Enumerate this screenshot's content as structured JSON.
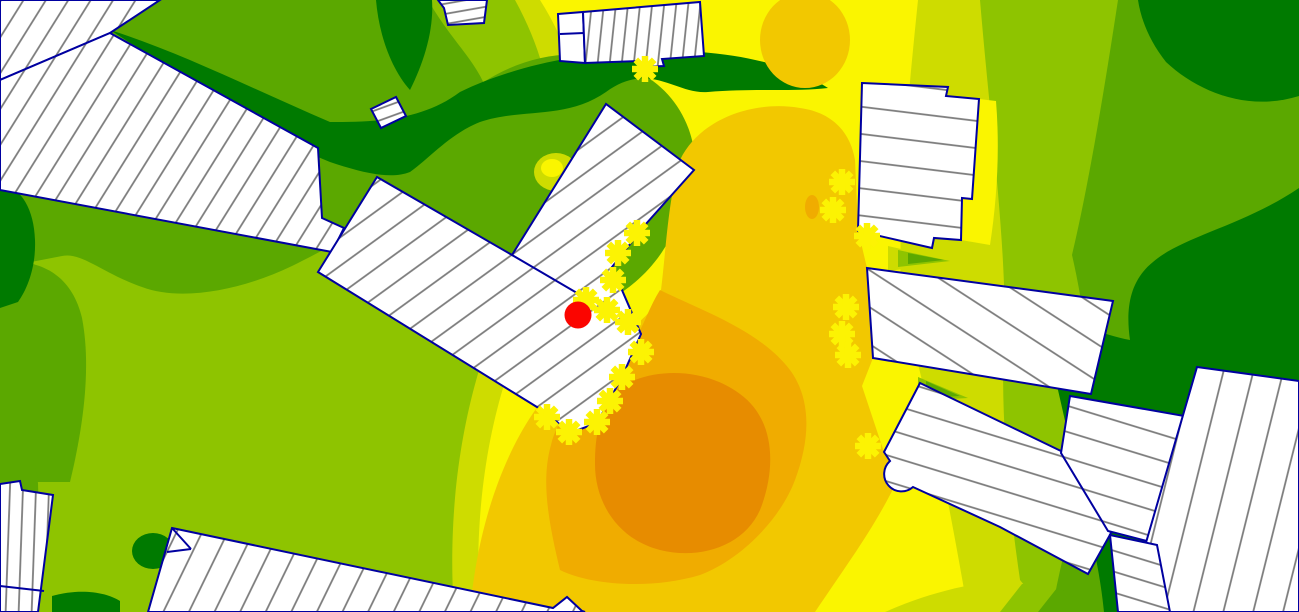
{
  "map": {
    "width": 1299,
    "height": 612,
    "description": "noise-contour-map-view",
    "palette": {
      "band_lt45": "#007A00",
      "band_45_50": "#5BA800",
      "band_50_55": "#8EC400",
      "band_55_60": "#CEDC00",
      "band_60_65": "#FAF500",
      "band_65_70": "#F2C800",
      "band_70_75": "#F0AC00",
      "band_gt75": "#E78C00",
      "building_fill": "#FFFFFF",
      "building_outline": "#0000A0",
      "hatch_line": "#7A7A7A",
      "receiver_marker": "#FCF303",
      "source_marker": "#FB0500"
    },
    "contours": [
      {
        "name": "base-yellow",
        "color": "band_60_65",
        "type": "path",
        "d": "M0,0 H1299 V612 H0 Z"
      },
      {
        "name": "left-yellowgreen",
        "color": "band_55_60",
        "type": "path",
        "d": "M0,0 L540,0 C575,55 585,110 582,165 C578,235 548,275 530,315 C505,372 488,430 481,505 C477,550 478,585 480,612 L0,612 Z"
      },
      {
        "name": "left-lightgreen",
        "color": "band_50_55",
        "type": "path",
        "d": "M0,0 L515,0 C548,60 556,115 552,165 C548,230 520,262 504,300 C480,358 462,420 455,498 C451,545 452,582 454,612 L0,612 Z"
      },
      {
        "name": "topleft-green",
        "color": "band_45_50",
        "type": "path",
        "d": "M0,0 L428,0 C452,42 478,62 488,94 C494,132 462,162 430,186 C392,214 332,246 292,266 C242,290 182,302 142,287 C102,273 82,252 62,256 L0,268 Z"
      },
      {
        "name": "leftedge-green",
        "color": "band_45_50",
        "type": "path",
        "d": "M0,262 C42,258 72,276 82,318 C92,370 82,432 70,482 L0,482 Z"
      },
      {
        "name": "leftlow-green",
        "color": "band_45_50",
        "type": "path",
        "d": "M0,430 C26,436 40,462 38,496 C36,530 20,552 0,556 Z"
      },
      {
        "name": "center-green-blob",
        "color": "band_45_50",
        "type": "path",
        "d": "M352,196 C402,160 432,120 472,90 C512,60 562,48 602,58 C652,70 682,100 692,140 C702,180 682,222 662,252 C642,282 612,302 582,312 C542,324 482,330 442,320 C402,310 372,282 357,252 C347,230 347,214 352,196 Z"
      },
      {
        "name": "darkgreen-band",
        "color": "band_lt45",
        "type": "path",
        "d": "M110,30 C180,52 255,90 330,122 C370,122 420,122 460,92 C530,58 620,46 700,52 C755,56 800,70 828,88 C795,92 755,88 708,92 C676,95 650,60 606,92 C566,120 520,108 480,122 C450,134 432,156 410,172 C390,180 360,172 330,162 C260,134 180,74 110,30 Z"
      },
      {
        "name": "darkgreen-spur",
        "color": "band_lt45",
        "type": "path",
        "d": "M376,0 L432,0 C434,30 424,62 410,90 C392,70 379,36 376,0 Z"
      },
      {
        "name": "darkgreen-leftedge",
        "color": "band_lt45",
        "type": "path",
        "d": "M0,182 C22,188 34,210 35,240 C36,266 28,288 18,302 L0,308 Z"
      },
      {
        "name": "darkgreen-tip",
        "color": "band_lt45",
        "type": "ellipse",
        "cx": 153,
        "cy": 551,
        "rx": 21,
        "ry": 18
      },
      {
        "name": "darkgreen-bottomleft",
        "color": "band_lt45",
        "type": "path",
        "d": "M52,596 C80,588 106,592 120,601 L120,612 L52,612 Z"
      },
      {
        "name": "right-yellowgreen",
        "color": "band_55_60",
        "type": "path",
        "d": "M918,0 L1299,0 L1299,612 L968,612 C952,520 930,400 901,300 C898,198 908,98 918,0 Z"
      },
      {
        "name": "right-lightgreen",
        "color": "band_50_55",
        "type": "path",
        "d": "M980,0 L1299,0 L1299,612 L1025,612 C1010,520 1000,420 1004,340 C1008,258 990,120 980,0 Z"
      },
      {
        "name": "right-green",
        "color": "band_45_50",
        "type": "path",
        "d": "M1118,0 L1299,0 L1299,612 L1052,612 C1062,548 1082,498 1088,438 C1095,375 1082,298 1072,255 C1088,188 1104,92 1118,0 Z"
      },
      {
        "name": "darkgreen-topright",
        "color": "band_lt45",
        "type": "path",
        "d": "M1138,0 L1299,0 L1299,96 C1248,112 1198,92 1166,62 C1150,42 1141,20 1138,0 Z"
      },
      {
        "name": "darkgreen-right-mass",
        "color": "band_lt45",
        "type": "path",
        "d": "M1299,188 C1243,226 1183,236 1153,262 C1128,282 1126,312 1130,340 C1103,335 1073,322 1043,312 L966,296 C1000,318 1040,352 1058,390 L1078,478 C1090,530 1100,570 1104,612 L1299,612 Z"
      },
      {
        "name": "yellow-halo-b6",
        "color": "band_60_65",
        "type": "path",
        "d": "M979,99 L996,101 C1000,150 997,200 990,245 L961,240 L961,198 L972,199 Z"
      },
      {
        "name": "gold-top-patch",
        "color": "band_65_70",
        "type": "ellipse",
        "cx": 805,
        "cy": 40,
        "rx": 45,
        "ry": 48
      },
      {
        "name": "gold-main",
        "color": "band_65_70",
        "type": "path",
        "d": "M680,160 C700,118 755,100 800,108 C830,112 850,130 855,160 L858,230 L867,268 L873,358 L862,386 L884,452 L902,470 C880,520 850,560 815,612 L470,612 C480,498 520,420 560,380 C600,340 650,330 661,290 C666,250 668,200 680,160 Z"
      },
      {
        "name": "orange-blob",
        "color": "band_70_75",
        "type": "path",
        "d": "M660,290 C700,310 760,330 790,370 C812,400 810,440 795,480 C780,520 740,560 700,575 C650,590 590,585 560,570 C548,520 541,480 551,445 C559,408 596,388 621,358 C641,338 646,312 660,290 Z"
      },
      {
        "name": "deep-orange-core",
        "color": "band_gt75",
        "type": "path",
        "d": "M612,394 C640,368 700,364 740,394 C776,420 776,470 760,510 C744,546 700,560 660,550 C620,540 595,505 595,464 C595,434 600,414 612,394 Z"
      },
      {
        "name": "orange-spot",
        "color": "band_70_75",
        "type": "ellipse",
        "cx": 812,
        "cy": 207,
        "rx": 7,
        "ry": 12
      },
      {
        "name": "yg-spot",
        "color": "band_55_60",
        "type": "ellipse",
        "cx": 556,
        "cy": 172,
        "rx": 22,
        "ry": 19
      },
      {
        "name": "yellow-spot",
        "color": "band_60_65",
        "type": "ellipse",
        "cx": 552,
        "cy": 168,
        "rx": 11,
        "ry": 9
      },
      {
        "name": "wedge-yg-bottom",
        "color": "band_55_60",
        "type": "path",
        "d": "M885,612 C930,592 980,580 1020,580 L1046,612 Z"
      },
      {
        "name": "wedge-lg-bottom",
        "color": "band_50_55",
        "type": "path",
        "d": "M1000,612 L1022,584 C1040,582 1052,590 1058,600 L1062,612 Z"
      },
      {
        "name": "wedge-g-bottom",
        "color": "band_45_50",
        "type": "path",
        "d": "M1038,612 L1057,588 C1070,592 1081,602 1086,612 Z"
      },
      {
        "name": "wedge-lg-a",
        "color": "band_50_55",
        "type": "path",
        "d": "M918,377 L968,398 L918,401 Z"
      },
      {
        "name": "wedge-g-a",
        "color": "band_45_50",
        "type": "path",
        "d": "M926,381 L960,396 L926,398 Z"
      },
      {
        "name": "wedge-yg-shadow",
        "color": "band_55_60",
        "type": "path",
        "d": "M888,246 L958,262 L888,271 Z"
      },
      {
        "name": "wedge-lg-shadow",
        "color": "band_50_55",
        "type": "path",
        "d": "M898,250 L950,261 L898,267 Z"
      },
      {
        "name": "wedge-g-shadow",
        "color": "band_45_50",
        "type": "path",
        "d": "M908,253 L944,260 L908,264 Z"
      }
    ],
    "buildings": [
      {
        "name": "building-topleft-strip",
        "d": "M0,0 L160,0 L110,33 L0,80 Z",
        "hatch_angle": -58,
        "hatch_gap": 19
      },
      {
        "name": "building-long-diagonal",
        "d": "M110,33 L318,148 L322,218 L344,228 L332,252 L0,190 L0,80 Z",
        "hatch_angle": -58,
        "hatch_gap": 19
      },
      {
        "name": "building-small-tilted",
        "d": "M371,109 L396,97 L406,116 L381,128 Z",
        "hatch_angle": -20,
        "hatch_gap": 11
      },
      {
        "name": "building-topedge-small",
        "d": "M438,0 L487,0 L484,23 L448,25 L444,8 Z",
        "hatch_angle": -10,
        "hatch_gap": 10
      },
      {
        "name": "building-top-annex",
        "d": "M558,14 L583,12 L585,63 L560,61 Z",
        "hatch_angle": -84,
        "hatch_gap": 60
      },
      {
        "name": "building-top-main",
        "d": "M583,12 L700,2 L704,56 L662,59 L664,66 L640,67 L638,61 L585,63 Z",
        "hatch_angle": -84,
        "hatch_gap": 12
      },
      {
        "name": "building-upper-right",
        "d": "M862,83 L948,87 L946,96 L979,99 L972,199 L962,198 L961,240 L934,238 L932,248 L858,231 Z",
        "hatch_angle": 7,
        "hatch_gap": 27
      },
      {
        "name": "building-right-wide",
        "d": "M867,268 L1113,301 L1091,394 L873,358 Z",
        "hatch_angle": 33,
        "hatch_gap": 31
      },
      {
        "name": "building-central-complex",
        "d": "M377,177 L512,255 L606,104 L694,170 L645,225 L612,267 L641,334 L622,377 L597,423 L570,433 L545,412 L318,272 Z",
        "hatch_angle": -36,
        "hatch_gap": 23
      },
      {
        "name": "building-cluster-a",
        "d": "M920,383 L1063,452 L1111,533 L1088,574 L1000,527 L913,487 A13,13 0 0,1 890,461 L884,452 Z",
        "hatch_angle": 17,
        "hatch_gap": 25
      },
      {
        "name": "building-cluster-b",
        "d": "M1070,396 L1190,417 L1168,492 L1147,541 L1108,531 L1061,453 Z",
        "hatch_angle": 17,
        "hatch_gap": 25
      },
      {
        "name": "building-cluster-c",
        "d": "M1197,367 L1299,381 L1299,612 L1160,612 L1136,577 Z",
        "hatch_angle": -76,
        "hatch_gap": 29
      },
      {
        "name": "building-cluster-d",
        "d": "M1110,535 L1157,545 L1170,612 L1118,612 Z",
        "hatch_angle": 17,
        "hatch_gap": 20
      },
      {
        "name": "building-left-edge",
        "d": "M0,484 L20,481 L22,490 L53,495 L38,612 L0,612 Z",
        "hatch_angle": -88,
        "hatch_gap": 13
      },
      {
        "name": "building-bottom-triangle",
        "d": "M172,528 L553,608 L567,597 L582,611 L585,612 L148,612 Z",
        "hatch_angle": -64,
        "hatch_gap": 23
      }
    ],
    "building_lines": [
      {
        "name": "complex-inner-edge",
        "x1": 512,
        "y1": 255,
        "x2": 577,
        "y2": 293
      },
      {
        "name": "annex-divider",
        "x1": 560,
        "y1": 34,
        "x2": 584,
        "y2": 33
      },
      {
        "name": "leftedge-divider",
        "x1": 0,
        "y1": 586,
        "x2": 44,
        "y2": 591
      },
      {
        "name": "triangle-notch-1",
        "x1": 172,
        "y1": 528,
        "x2": 191,
        "y2": 549
      },
      {
        "name": "triangle-notch-2",
        "x1": 191,
        "y1": 549,
        "x2": 167,
        "y2": 552
      }
    ],
    "receivers": [
      [
        637,
        233
      ],
      [
        618,
        253
      ],
      [
        613,
        280
      ],
      [
        586,
        300
      ],
      [
        607,
        310
      ],
      [
        628,
        322
      ],
      [
        641,
        352
      ],
      [
        622,
        377
      ],
      [
        610,
        401
      ],
      [
        597,
        422
      ],
      [
        569,
        432
      ],
      [
        547,
        417
      ],
      [
        645,
        69
      ],
      [
        842,
        182
      ],
      [
        833,
        210
      ],
      [
        867,
        236
      ],
      [
        846,
        307
      ],
      [
        842,
        334
      ],
      [
        848,
        355
      ],
      [
        868,
        446
      ]
    ],
    "receiver_style": {
      "arm_radius": 13,
      "stroke_width": 6.5
    },
    "source_point": {
      "x": 578,
      "y": 315,
      "r": 13.5
    }
  }
}
